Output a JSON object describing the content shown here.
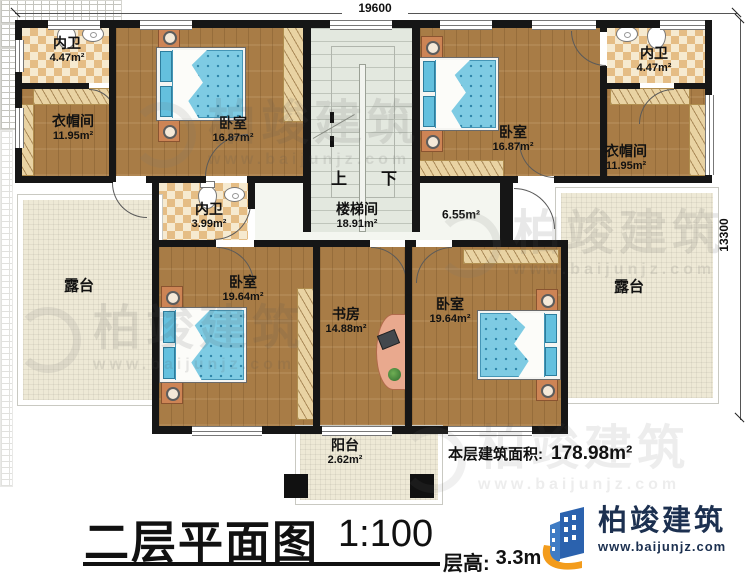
{
  "dimensions": {
    "top": "19600",
    "right": "13300"
  },
  "stairs": {
    "up": "上",
    "down": "下"
  },
  "rooms": [
    {
      "name": "内卫",
      "area": "4.47m²"
    },
    {
      "name": "衣帽间",
      "area": "11.95m²"
    },
    {
      "name": "卧室",
      "area": "16.87m²"
    },
    {
      "name": "卧室",
      "area": "16.87m²"
    },
    {
      "name": "衣帽间",
      "area": "11.95m²"
    },
    {
      "name": "内卫",
      "area": "4.47m²"
    },
    {
      "name": "内卫",
      "area": "3.99m²"
    },
    {
      "name": "楼梯间",
      "area": "18.91m²"
    },
    {
      "name": "",
      "area": "6.55m²"
    },
    {
      "name": "露台",
      "area": ""
    },
    {
      "name": "露台",
      "area": ""
    },
    {
      "name": "卧室",
      "area": "19.64m²"
    },
    {
      "name": "书房",
      "area": "14.88m²"
    },
    {
      "name": "卧室",
      "area": "19.64m²"
    },
    {
      "name": "阳台",
      "area": "2.62m²"
    }
  ],
  "summary": {
    "label": "本层建筑面积:",
    "value": "178.98m²"
  },
  "titleblock": {
    "title": "二层平面图",
    "scale": "1:100",
    "floor_height_label": "层高:",
    "floor_height_value": "3.3m"
  },
  "branding": {
    "company": "柏竣建筑",
    "website": "www.baijunjz.com"
  }
}
